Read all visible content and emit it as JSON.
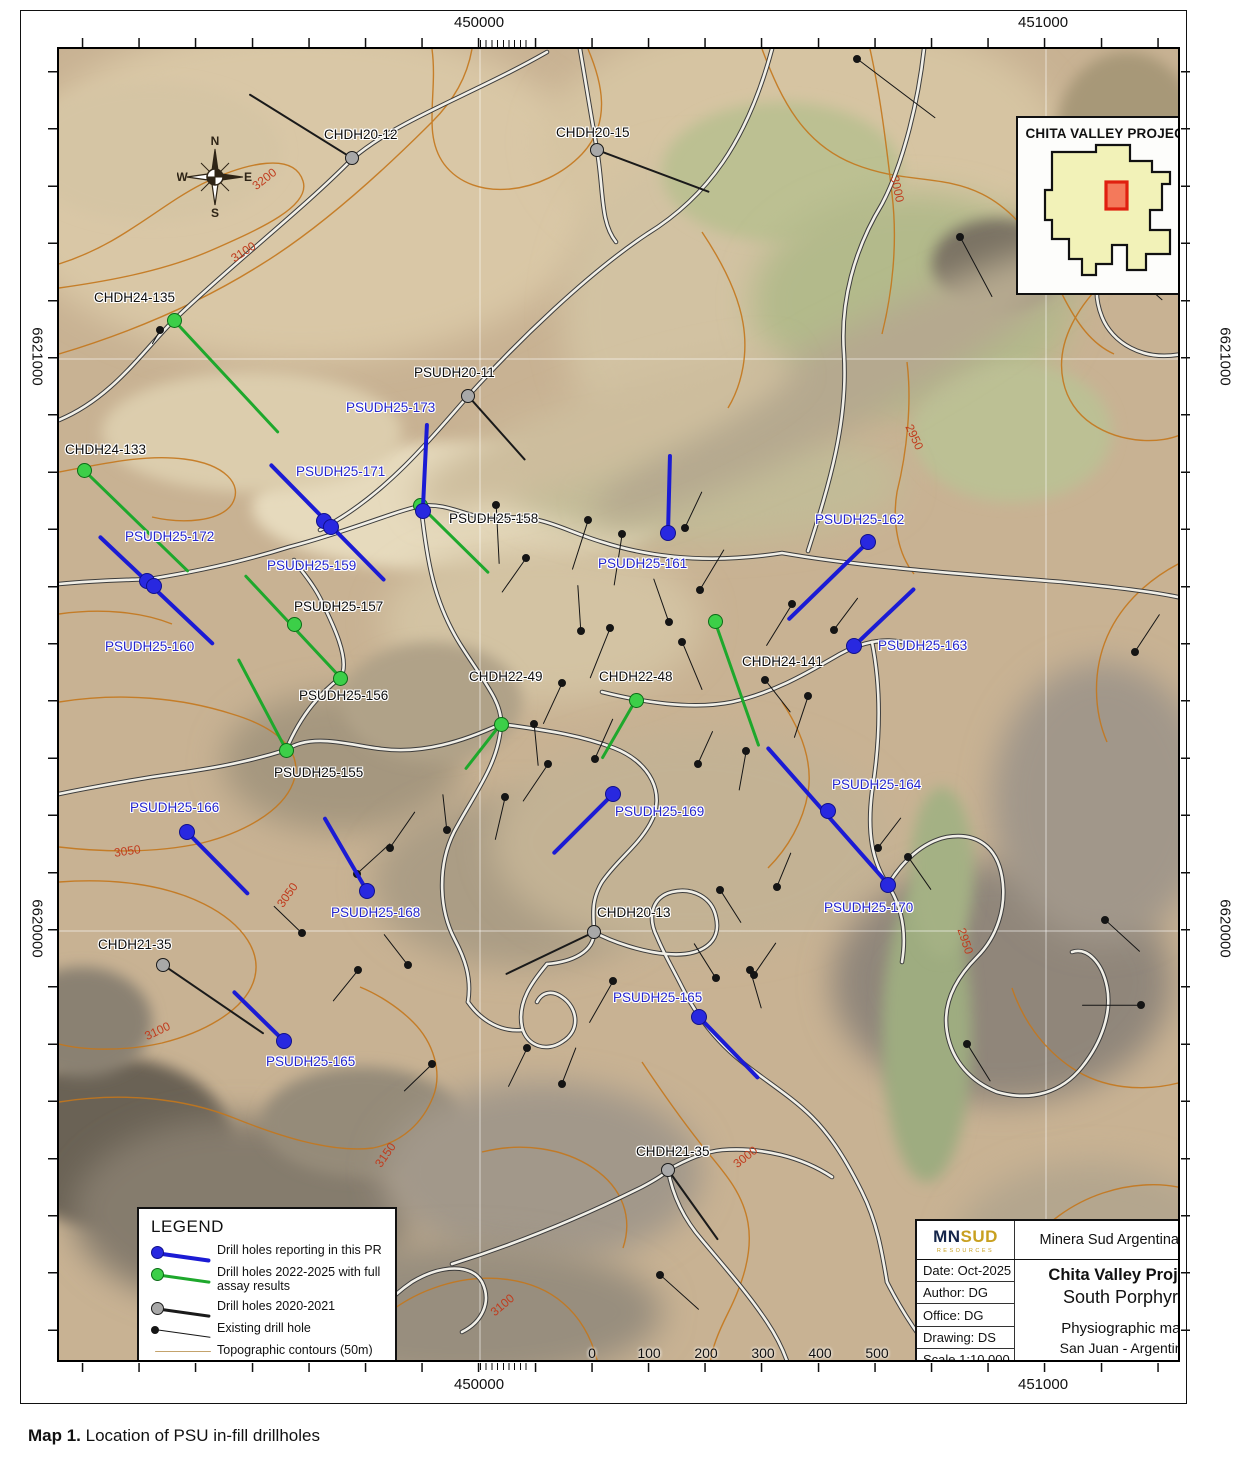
{
  "caption": {
    "bold": "Map 1.",
    "text": " Location of PSU in-fill drillholes"
  },
  "frame": {
    "top": [
      "450000",
      "451000"
    ],
    "bottom": [
      "450000",
      "451000"
    ],
    "left": [
      "6621000",
      "6620000"
    ],
    "right": [
      "6621000",
      "6620000"
    ]
  },
  "inset": {
    "title": "CHITA VALLEY PROJECT"
  },
  "compass": {
    "n": "N",
    "e": "E",
    "s": "S",
    "w": "W"
  },
  "legend": {
    "title": "LEGEND",
    "items": [
      {
        "type": "blue",
        "label": "Drill holes reporting in this PR"
      },
      {
        "type": "green",
        "label": "Drill holes 2022-2025 with full assay results"
      },
      {
        "type": "gray",
        "label": "Drill holes 2020-2021"
      },
      {
        "type": "existing",
        "label": "Existing drill hole"
      },
      {
        "type": "contour",
        "label": "Topographic contours (50m)"
      },
      {
        "type": "road",
        "label": "Road"
      }
    ]
  },
  "scalebar": {
    "labels": [
      "0",
      "100",
      "200",
      "300",
      "400",
      "500"
    ],
    "unit": "Meters"
  },
  "titleblock": {
    "logo_mn": "MN",
    "logo_sud": "SUD",
    "logo_sub": "RESOURCES",
    "company": "Minera Sud Argentina S.A.",
    "date": "Date: Oct-2025",
    "author": "Author: DG",
    "office": "Office: DG",
    "drawing": "Drawing: DS",
    "scale": "Scale 1:10.000",
    "project": "Chita Valley Project",
    "subtitle": "South Porphyry",
    "maptype": "Physiographic map",
    "location": "San Juan - Argentine",
    "projection": "Projection: UTM 19S - WGS84"
  },
  "colors": {
    "blue_line": "#1b1bd4",
    "blue_dot": "#2828e0",
    "blue_dot_border": "#10108a",
    "blue_label": "#2525cc",
    "green_line": "#1ea82c",
    "green_dot": "#3ccf48",
    "green_dot_border": "#0b6b16",
    "gray_line": "#1a1a1a",
    "gray_dot": "#a8a8a8",
    "gray_dot_border": "#1a1a1a",
    "existing": "#151515",
    "black_label": "#0d0d0d",
    "contour": "#c4771c",
    "contour_label": "#c03c1e",
    "road_casing": "#3c3c3c",
    "road_fill": "#f1efe7"
  },
  "contour_labels": [
    {
      "text": "3200",
      "x": 249,
      "y": 170,
      "rot": -38
    },
    {
      "text": "3100",
      "x": 228,
      "y": 243,
      "rot": -33
    },
    {
      "text": "3000",
      "x": 882,
      "y": 180,
      "rot": 78
    },
    {
      "text": "2950",
      "x": 899,
      "y": 428,
      "rot": 65
    },
    {
      "text": "3050",
      "x": 112,
      "y": 842,
      "rot": -8
    },
    {
      "text": "3050",
      "x": 272,
      "y": 886,
      "rot": -55
    },
    {
      "text": "3100",
      "x": 142,
      "y": 1022,
      "rot": -25
    },
    {
      "text": "3150",
      "x": 370,
      "y": 1146,
      "rot": -55
    },
    {
      "text": "3000",
      "x": 730,
      "y": 1148,
      "rot": -38
    },
    {
      "text": "3100",
      "x": 487,
      "y": 1296,
      "rot": -40
    },
    {
      "text": "2950",
      "x": 950,
      "y": 932,
      "rot": 72
    }
  ],
  "drillholes": {
    "blue": [
      {
        "label": "PSUDH25-173",
        "lx": 344,
        "ly": 398,
        "x": 421,
        "y": 509,
        "line": [
          425,
          421,
          421,
          505
        ]
      },
      {
        "label": "PSUDH25-171",
        "lx": 294,
        "ly": 462,
        "x": 322,
        "y": 519,
        "line": [
          268,
          462,
          383,
          579
        ]
      },
      {
        "label": "PSUDH25-159",
        "lx": 265,
        "ly": 556,
        "x": 329,
        "y": 525,
        "line": null
      },
      {
        "label": "PSUDH25-172",
        "lx": 123,
        "ly": 527,
        "x": 145,
        "y": 579,
        "line": [
          97,
          534,
          212,
          643
        ]
      },
      {
        "label": "PSUDH25-160",
        "lx": 103,
        "ly": 637,
        "x": 152,
        "y": 584,
        "line": null
      },
      {
        "label": "PSUDH25-161",
        "lx": 596,
        "ly": 554,
        "x": 666,
        "y": 531,
        "line": [
          668,
          452,
          666,
          531
        ]
      },
      {
        "label": "PSUDH25-162",
        "lx": 813,
        "ly": 510,
        "x": 866,
        "y": 540,
        "line": [
          866,
          540,
          786,
          618
        ]
      },
      {
        "label": "PSUDH25-163",
        "lx": 876,
        "ly": 636,
        "x": 852,
        "y": 644,
        "line": [
          852,
          644,
          913,
          586
        ]
      },
      {
        "label": "PSUDH25-164",
        "lx": 830,
        "ly": 775,
        "x": 826,
        "y": 809,
        "line": [
          765,
          745,
          886,
          882
        ]
      },
      {
        "label": "PSUDH25-170",
        "lx": 822,
        "ly": 898,
        "x": 886,
        "y": 883,
        "line": null
      },
      {
        "label": "PSUDH25-169",
        "lx": 613,
        "ly": 802,
        "x": 611,
        "y": 792,
        "line": [
          611,
          792,
          551,
          852
        ]
      },
      {
        "label": "PSUDH25-166",
        "lx": 128,
        "ly": 798,
        "x": 185,
        "y": 830,
        "line": [
          185,
          830,
          247,
          893
        ]
      },
      {
        "label": "PSUDH25-168",
        "lx": 329,
        "ly": 903,
        "x": 365,
        "y": 889,
        "line": [
          322,
          815,
          365,
          889
        ]
      },
      {
        "label": "PSUDH25-165",
        "lx": 264,
        "ly": 1052,
        "x": 282,
        "y": 1039,
        "line": [
          231,
          989,
          282,
          1039
        ]
      },
      {
        "label": "PSUDH25-165",
        "lx": 611,
        "ly": 988,
        "x": 697,
        "y": 1015,
        "line": [
          697,
          1015,
          757,
          1077
        ]
      }
    ],
    "green": [
      {
        "label": "CHDH24-135",
        "lx": 92,
        "ly": 288,
        "x": 172,
        "y": 318,
        "line": [
          172,
          318,
          277,
          431
        ]
      },
      {
        "label": "CHDH24-133",
        "lx": 63,
        "ly": 440,
        "x": 82,
        "y": 468,
        "line": [
          82,
          468,
          187,
          570
        ]
      },
      {
        "label": "PSUDH25-158",
        "lx": 447,
        "ly": 509,
        "x": 418,
        "y": 503,
        "line": [
          418,
          503,
          487,
          571
        ]
      },
      {
        "label": "PSUDH25-157",
        "lx": 292,
        "ly": 597,
        "x": 292,
        "y": 622,
        "line": [
          243,
          573,
          341,
          678
        ]
      },
      {
        "label": "PSUDH25-156",
        "lx": 297,
        "ly": 686,
        "x": 338,
        "y": 676,
        "line": null
      },
      {
        "label": "PSUDH25-155",
        "lx": 272,
        "ly": 763,
        "x": 284,
        "y": 748,
        "line": [
          284,
          748,
          236,
          657
        ]
      },
      {
        "label": "CHDH22-49",
        "lx": 467,
        "ly": 667,
        "x": 499,
        "y": 722,
        "line": [
          499,
          722,
          463,
          768
        ]
      },
      {
        "label": "CHDH22-48",
        "lx": 597,
        "ly": 667,
        "x": 634,
        "y": 698,
        "line": [
          634,
          698,
          600,
          757
        ]
      },
      {
        "label": "CHDH24-141",
        "lx": 740,
        "ly": 652,
        "x": 713,
        "y": 619,
        "line": [
          713,
          619,
          757,
          744
        ]
      }
    ],
    "gray": [
      {
        "label": "CHDH20-12",
        "lx": 322,
        "ly": 125,
        "x": 350,
        "y": 156,
        "line": [
          350,
          156,
          247,
          92
        ]
      },
      {
        "label": "CHDH20-15",
        "lx": 554,
        "ly": 123,
        "x": 595,
        "y": 148,
        "line": [
          595,
          148,
          707,
          190
        ]
      },
      {
        "label": "PSUDH20-11",
        "lx": 412,
        "ly": 363,
        "x": 466,
        "y": 394,
        "line": [
          466,
          394,
          523,
          458
        ]
      },
      {
        "label": "CHDH20-13",
        "lx": 595,
        "ly": 903,
        "x": 592,
        "y": 930,
        "line": [
          592,
          930,
          504,
          972
        ]
      },
      {
        "label": "CHDH21-35",
        "lx": 96,
        "ly": 935,
        "x": 161,
        "y": 963,
        "line": [
          161,
          963,
          262,
          1032
        ]
      },
      {
        "label": "CHDH21-35",
        "lx": 634,
        "ly": 1142,
        "x": 666,
        "y": 1168,
        "line": [
          666,
          1168,
          716,
          1238
        ]
      }
    ],
    "existing": [
      [
        855,
        57,
        933,
        116
      ],
      [
        1092,
        238,
        1160,
        298
      ],
      [
        958,
        235,
        990,
        295
      ],
      [
        158,
        328,
        150,
        342
      ],
      [
        494,
        503,
        497,
        562
      ],
      [
        586,
        518,
        570,
        568
      ],
      [
        524,
        556,
        500,
        590
      ],
      [
        620,
        532,
        612,
        583
      ],
      [
        667,
        620,
        652,
        577
      ],
      [
        608,
        626,
        588,
        676
      ],
      [
        579,
        629,
        576,
        583
      ],
      [
        683,
        526,
        700,
        490
      ],
      [
        698,
        588,
        722,
        548
      ],
      [
        790,
        602,
        764,
        644
      ],
      [
        832,
        628,
        856,
        596
      ],
      [
        680,
        640,
        700,
        688
      ],
      [
        763,
        678,
        788,
        710
      ],
      [
        806,
        694,
        792,
        736
      ],
      [
        744,
        749,
        737,
        788
      ],
      [
        593,
        757,
        611,
        717
      ],
      [
        560,
        681,
        541,
        722
      ],
      [
        532,
        722,
        536,
        764
      ],
      [
        546,
        762,
        521,
        799
      ],
      [
        503,
        795,
        493,
        838
      ],
      [
        445,
        828,
        441,
        792
      ],
      [
        388,
        846,
        413,
        810
      ],
      [
        355,
        872,
        388,
        842
      ],
      [
        300,
        931,
        272,
        904
      ],
      [
        356,
        968,
        331,
        999
      ],
      [
        406,
        963,
        382,
        932
      ],
      [
        430,
        1062,
        402,
        1089
      ],
      [
        525,
        1046,
        506,
        1085
      ],
      [
        560,
        1082,
        574,
        1046
      ],
      [
        611,
        979,
        587,
        1021
      ],
      [
        696,
        762,
        711,
        729
      ],
      [
        718,
        888,
        739,
        921
      ],
      [
        775,
        885,
        789,
        851
      ],
      [
        748,
        968,
        759,
        1006
      ],
      [
        876,
        846,
        899,
        816
      ],
      [
        906,
        855,
        929,
        888
      ],
      [
        1133,
        650,
        1158,
        612
      ],
      [
        1103,
        918,
        1138,
        950
      ],
      [
        1139,
        1003,
        1080,
        1003
      ],
      [
        965,
        1042,
        988,
        1079
      ],
      [
        714,
        976,
        692,
        941
      ],
      [
        752,
        973,
        774,
        941
      ],
      [
        658,
        1273,
        697,
        1308
      ]
    ]
  }
}
